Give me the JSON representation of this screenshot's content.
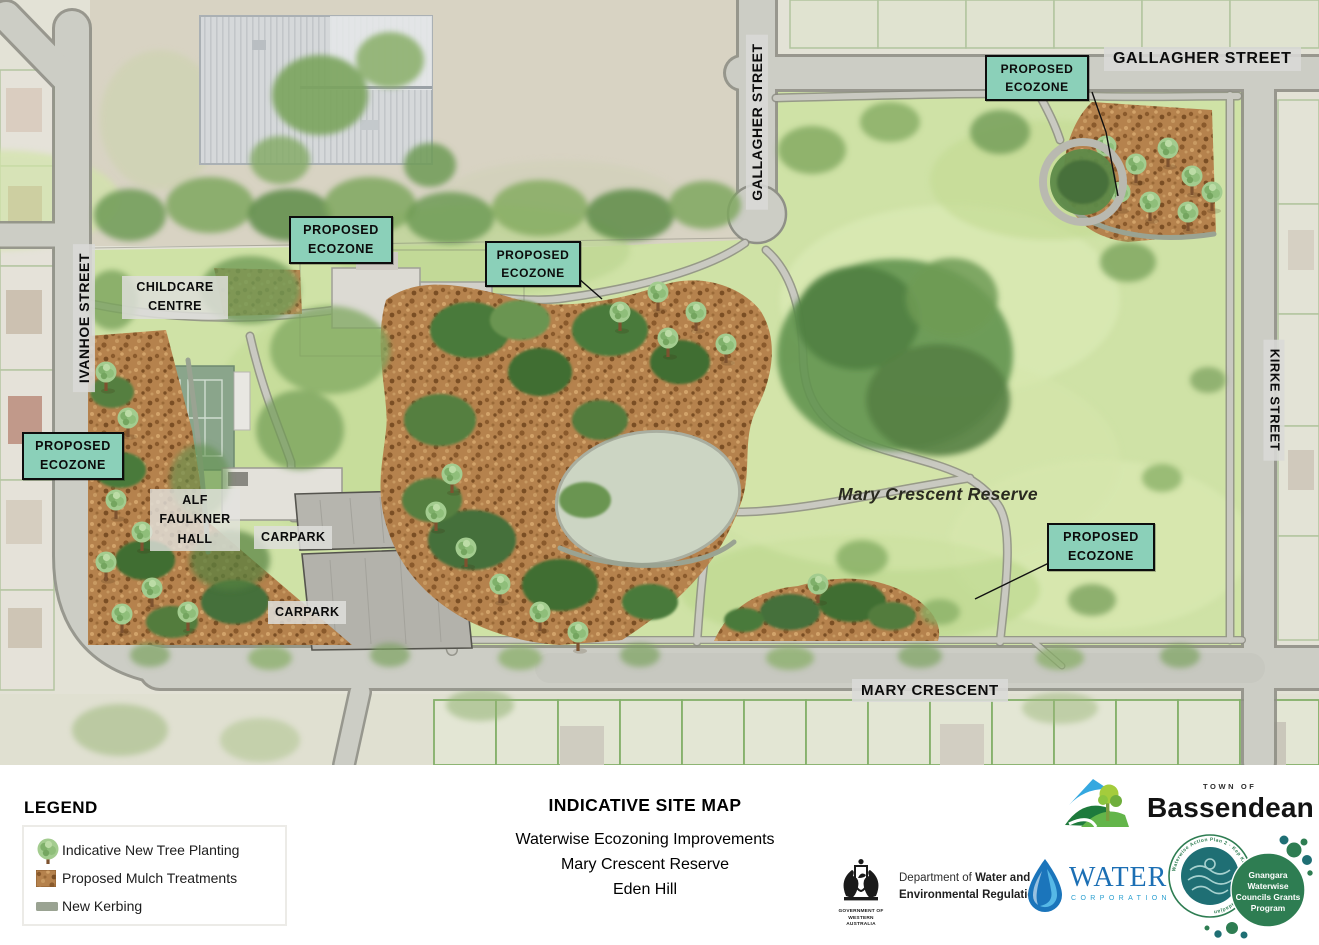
{
  "map": {
    "ecozone_label": {
      "line1": "PROPOSED",
      "line2": "ECOZONE"
    },
    "streets": {
      "gallagher_vertical": "GALLAGHER STREET",
      "gallagher_horizontal": "GALLAGHER STREET",
      "ivanhoe": "IVANHOE STREET",
      "kirke": "KIRKE STREET",
      "mary_crescent": "MARY CRESCENT"
    },
    "sites": {
      "childcare_line1": "CHILDCARE",
      "childcare_line2": "CENTRE",
      "hall_line1": "ALF",
      "hall_line2": "FAULKNER",
      "hall_line3": "HALL",
      "carpark_upper": "CARPARK",
      "carpark_lower": "CARPARK",
      "reserve_name": "Mary Crescent Reserve"
    },
    "colors": {
      "ecozone_fill": "#8BD0B9",
      "mulch": "#B5824D",
      "kerbing": "#9AA392"
    }
  },
  "legend": {
    "title": "LEGEND",
    "items": [
      {
        "icon": "tree-icon",
        "label": "Indicative New Tree Planting"
      },
      {
        "icon": "mulch-icon",
        "label": "Proposed Mulch Treatments"
      },
      {
        "icon": "kerb-icon",
        "label": "New Kerbing"
      }
    ]
  },
  "title_block": {
    "title": "INDICATIVE SITE MAP",
    "subtitle_line1": "Waterwise Ecozoning Improvements",
    "subtitle_line2": "Mary Crescent Reserve",
    "subtitle_line3": "Eden Hill"
  },
  "logos": {
    "bassendean": {
      "tagline": "TOWN OF",
      "name": "Bassendean"
    },
    "government": {
      "dept_prefix": "Department of ",
      "dept_bold1": "Water and",
      "dept_line2": "Environmental Regulation",
      "crest_line1": "GOVERNMENT OF",
      "crest_line2": "WESTERN AUSTRALIA"
    },
    "water_corporation": {
      "name": "WATER",
      "subname": "CORPORATION"
    },
    "grants_program": {
      "rim_text": "Waterwise Action Plan 2 · Kep Katitjin · Gabi Kaadadjan",
      "line1": "Gnangara",
      "line2": "Waterwise",
      "line3": "Councils Grants",
      "line4": "Program"
    }
  }
}
